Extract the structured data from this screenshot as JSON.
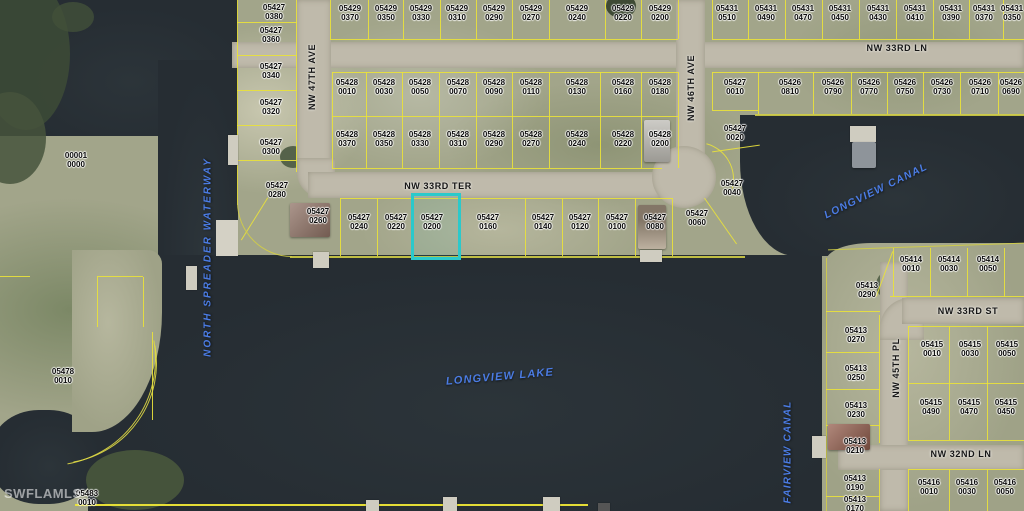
{
  "map": {
    "watermark": "SWFLAMLS",
    "highlighted_parcel": "05427 0200",
    "colors": {
      "water": "#262d33",
      "land": "#a2a58a",
      "road": "#bfbaab",
      "parcel_line": "#e8e13c",
      "highlight": "#2bc9cb",
      "water_label": "#4b7ce4"
    }
  },
  "streets": {
    "nw47": "NW 47TH AVE",
    "nw46": "NW 46TH AVE",
    "nw45": "NW 45TH PL",
    "ln33": "NW 33RD LN",
    "ter33": "NW 33RD TER",
    "st33": "NW 33RD ST",
    "ln32": "NW 32ND LN"
  },
  "water_labels": {
    "spreader": "NORTH SPREADER WATERWAY",
    "longview_canal": "LONGVIEW CANAL",
    "longview_lake": "LONGVIEW LAKE",
    "fairview_canal": "FAIRVIEW CANAL"
  },
  "parcels": [
    {
      "t": "05429 0370"
    },
    {
      "t": "05429 0350"
    },
    {
      "t": "05429 0330"
    },
    {
      "t": "05429 0310"
    },
    {
      "t": "05429 0290"
    },
    {
      "t": "05429 0270"
    },
    {
      "t": "05429 0240"
    },
    {
      "t": "05429 0220"
    },
    {
      "t": "05429 0200"
    },
    {
      "t": "05431 0510"
    },
    {
      "t": "05431 0490"
    },
    {
      "t": "05431 0470"
    },
    {
      "t": "05431 0450"
    },
    {
      "t": "05431 0430"
    },
    {
      "t": "05431 0410"
    },
    {
      "t": "05431 0390"
    },
    {
      "t": "05431 0370"
    },
    {
      "t": "05431 0350"
    },
    {
      "t": "05428 0010"
    },
    {
      "t": "05428 0030"
    },
    {
      "t": "05428 0050"
    },
    {
      "t": "05428 0070"
    },
    {
      "t": "05428 0090"
    },
    {
      "t": "05428 0110"
    },
    {
      "t": "05428 0130"
    },
    {
      "t": "05428 0160"
    },
    {
      "t": "05428 0180"
    },
    {
      "t": "05428 0370"
    },
    {
      "t": "05428 0350"
    },
    {
      "t": "05428 0330"
    },
    {
      "t": "05428 0310"
    },
    {
      "t": "05428 0290"
    },
    {
      "t": "05428 0270"
    },
    {
      "t": "05428 0240"
    },
    {
      "t": "05428 0220"
    },
    {
      "t": "05428 0200"
    },
    {
      "t": "05427 0010"
    },
    {
      "t": "05427 0020"
    },
    {
      "t": "05426 0810"
    },
    {
      "t": "05426 0790"
    },
    {
      "t": "05426 0770"
    },
    {
      "t": "05426 0750"
    },
    {
      "t": "05426 0730"
    },
    {
      "t": "05426 0710"
    },
    {
      "t": "05426 0690"
    },
    {
      "t": "05427 0380"
    },
    {
      "t": "05427 0360"
    },
    {
      "t": "05427 0340"
    },
    {
      "t": "05427 0320"
    },
    {
      "t": "05427 0300"
    },
    {
      "t": "05427 0280"
    },
    {
      "t": "05427 0260"
    },
    {
      "t": "05427 0240"
    },
    {
      "t": "05427 0220"
    },
    {
      "t": "05427 0200"
    },
    {
      "t": "05427 0160"
    },
    {
      "t": "05427 0140"
    },
    {
      "t": "05427 0120"
    },
    {
      "t": "05427 0100"
    },
    {
      "t": "05427 0080"
    },
    {
      "t": "05427 0060"
    },
    {
      "t": "05427 0040"
    },
    {
      "t": "00001 0000"
    },
    {
      "t": "05478 0010"
    },
    {
      "t": "05483 0010"
    },
    {
      "t": "05414 0010"
    },
    {
      "t": "05414 0030"
    },
    {
      "t": "05414 0050"
    },
    {
      "t": "05413 0290"
    },
    {
      "t": "05413 0270"
    },
    {
      "t": "05413 0250"
    },
    {
      "t": "05413 0230"
    },
    {
      "t": "05413 0210"
    },
    {
      "t": "05413 0190"
    },
    {
      "t": "05413 0170"
    },
    {
      "t": "05415 0010"
    },
    {
      "t": "05415 0030"
    },
    {
      "t": "05415 0050"
    },
    {
      "t": "05415 0490"
    },
    {
      "t": "05415 0470"
    },
    {
      "t": "05415 0450"
    },
    {
      "t": "05416 0010"
    },
    {
      "t": "05416 0030"
    },
    {
      "t": "05416 0050"
    }
  ]
}
